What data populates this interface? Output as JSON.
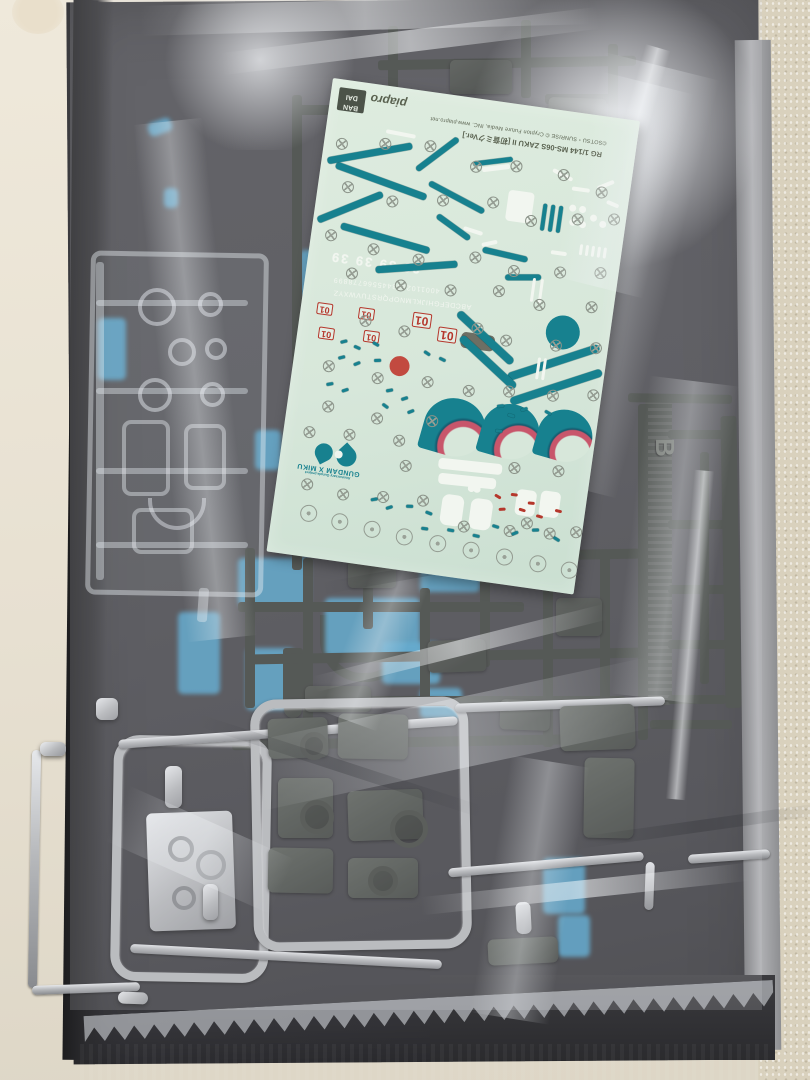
{
  "scene": {
    "subject": "Opened Gunpla model-kit box: plastic runners sealed in a bag with a water-slide decal sheet lying on top"
  },
  "decal_sheet": {
    "bandai_logo_line1": "BAN",
    "bandai_logo_line2": "DAI",
    "piapro_logo": "piapro",
    "credit_line": "©SOTSU・SUNRISE  © Crypton Future Media, INC.  www.piapro.net",
    "product_line": "RG 1/144 MS-06S ZAKU II [初音ミクVer.]",
    "numbers_row": "39 39 39 39",
    "digits_strip": "4001102233445566778899",
    "letters_strip": "ABCDEFGHIJKLMNOPQRSTUVWXYZ",
    "red_marking": "01",
    "emblem_title": "GUNDAM X MIKU",
    "emblem_subtitle": "Anniversary Gunpla project",
    "colors": {
      "sheet": "#d7e7da",
      "teal": "#17818f",
      "red": "#b5372c",
      "pink": "#c8566b",
      "white": "#f2f6f0",
      "print": "#565e50"
    }
  },
  "runners": {
    "slot_letter": "B",
    "colors": {
      "dark": "#383c38",
      "silver": "#b6b8bb",
      "blue": "#4da4cf"
    }
  }
}
